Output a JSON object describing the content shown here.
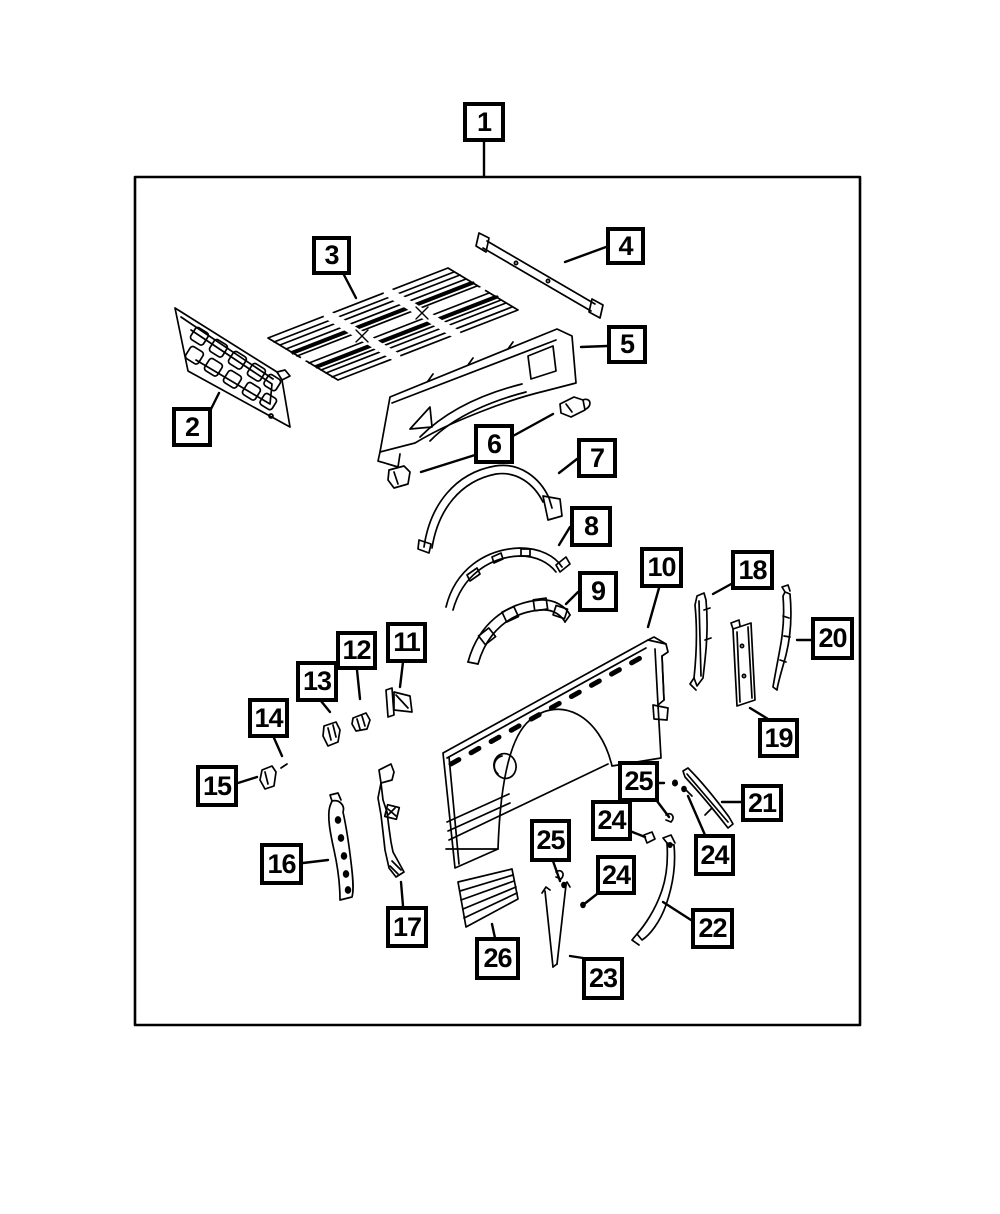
{
  "figure": {
    "type": "exploded-parts-diagram",
    "subject": "pickup-truck-bed-box-panels",
    "background_color": "#ffffff",
    "line_color": "#000000",
    "callouts": [
      {
        "id": "1",
        "label": "1"
      },
      {
        "id": "2",
        "label": "2"
      },
      {
        "id": "3",
        "label": "3"
      },
      {
        "id": "4",
        "label": "4"
      },
      {
        "id": "5",
        "label": "5"
      },
      {
        "id": "6",
        "label": "6"
      },
      {
        "id": "7",
        "label": "7"
      },
      {
        "id": "8",
        "label": "8"
      },
      {
        "id": "9",
        "label": "9"
      },
      {
        "id": "10",
        "label": "10"
      },
      {
        "id": "11",
        "label": "11"
      },
      {
        "id": "12",
        "label": "12"
      },
      {
        "id": "13",
        "label": "13"
      },
      {
        "id": "14",
        "label": "14"
      },
      {
        "id": "15",
        "label": "15"
      },
      {
        "id": "16",
        "label": "16"
      },
      {
        "id": "17",
        "label": "17"
      },
      {
        "id": "18",
        "label": "18"
      },
      {
        "id": "19",
        "label": "19"
      },
      {
        "id": "20",
        "label": "20"
      },
      {
        "id": "21",
        "label": "21"
      },
      {
        "id": "22",
        "label": "22"
      },
      {
        "id": "23",
        "label": "23"
      },
      {
        "id": "24a",
        "label": "24"
      },
      {
        "id": "24b",
        "label": "24"
      },
      {
        "id": "24c",
        "label": "24"
      },
      {
        "id": "25a",
        "label": "25"
      },
      {
        "id": "25b",
        "label": "25"
      },
      {
        "id": "26",
        "label": "26"
      }
    ]
  }
}
